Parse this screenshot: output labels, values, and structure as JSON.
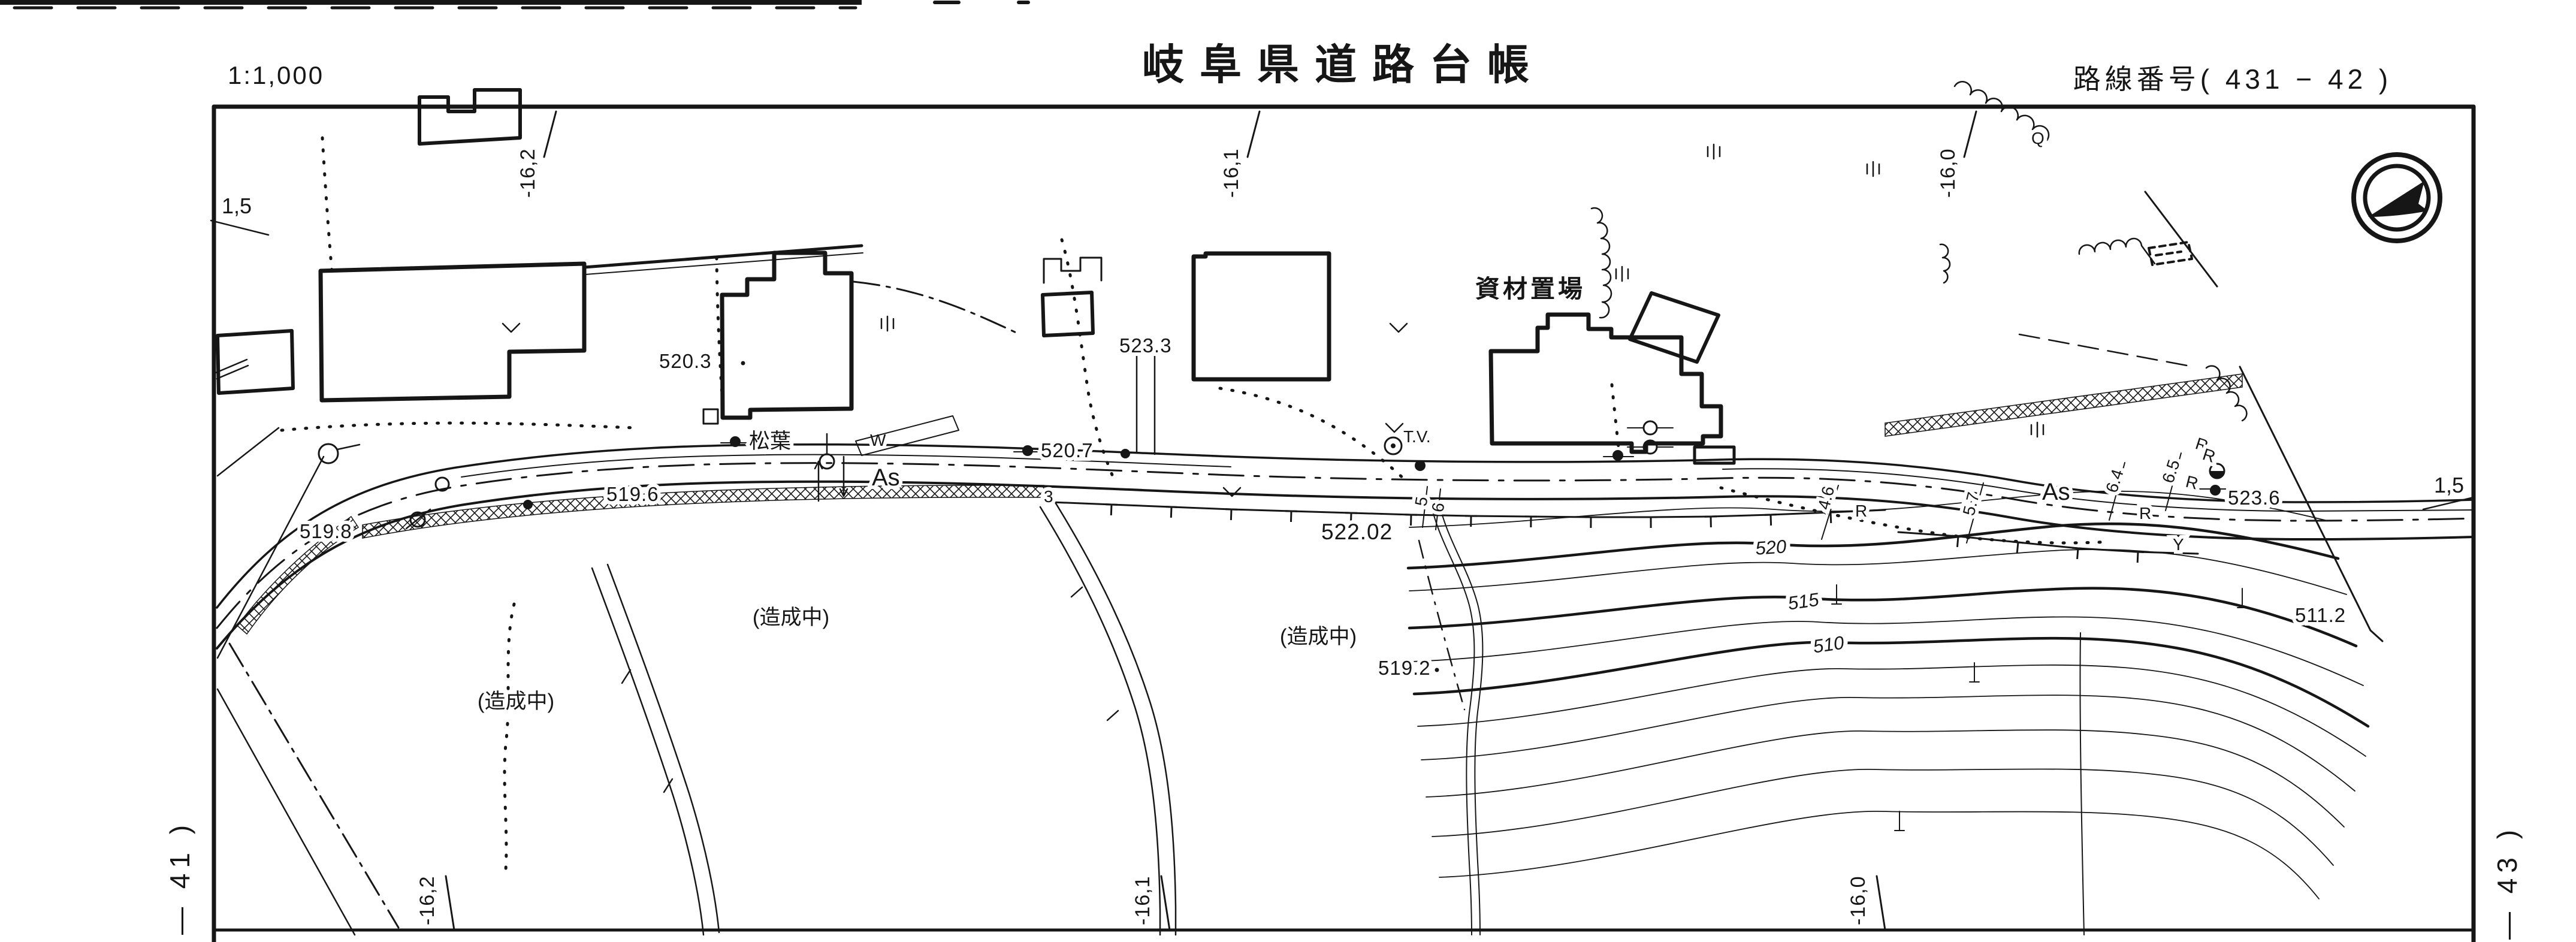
{
  "document": {
    "kind": "scanned cadastral road ledger sheet",
    "scale_label": "1:1,000",
    "title": "岐阜県道路台帳",
    "route_label": "路線番号( 431 − 42 )"
  },
  "frame_marks": {
    "top_ticks": [
      "-16,2",
      "-16,1",
      "-16,0"
    ],
    "bottom_ticks": [
      "-16,2",
      "-16,1",
      "-16,0"
    ],
    "left_station": "1,5",
    "right_station": "1,5",
    "left_sheet_ref": "— 41 )",
    "right_sheet_ref": "— 43 )"
  },
  "map": {
    "spot_elevations": {
      "e519_8": "519.8",
      "e520_3": "520.3",
      "e519_6": "519.6",
      "e523_3": "523.3",
      "e520_7": "520.7",
      "e522_02": "522.02",
      "e519_2": "519.2",
      "e523_6": "523.6",
      "e511_2": "511.2"
    },
    "contour_labels": {
      "c520": "520",
      "c515": "515",
      "c510": "510"
    },
    "place_labels": {
      "matsuba": "松葉",
      "material_yard": "資材置場",
      "under_construction": "(造成中)"
    },
    "surface_labels": {
      "as_left": "As",
      "as_right": "As"
    },
    "point_labels": {
      "w": "W",
      "tv": "T.V.",
      "q": "Q",
      "lot3": "3",
      "y": "Y",
      "rail": "R"
    },
    "width_annotations": {
      "wa1": "4.6",
      "wa2": "5.7",
      "wa3": "6.4",
      "wa4": "6.5",
      "wa5": "5",
      "wa6": "6"
    },
    "symbols": {
      "north_arrow": "north-arrow-in-double-circle"
    },
    "colors": {
      "ink": "#161616",
      "paper": "#ffffff"
    }
  }
}
